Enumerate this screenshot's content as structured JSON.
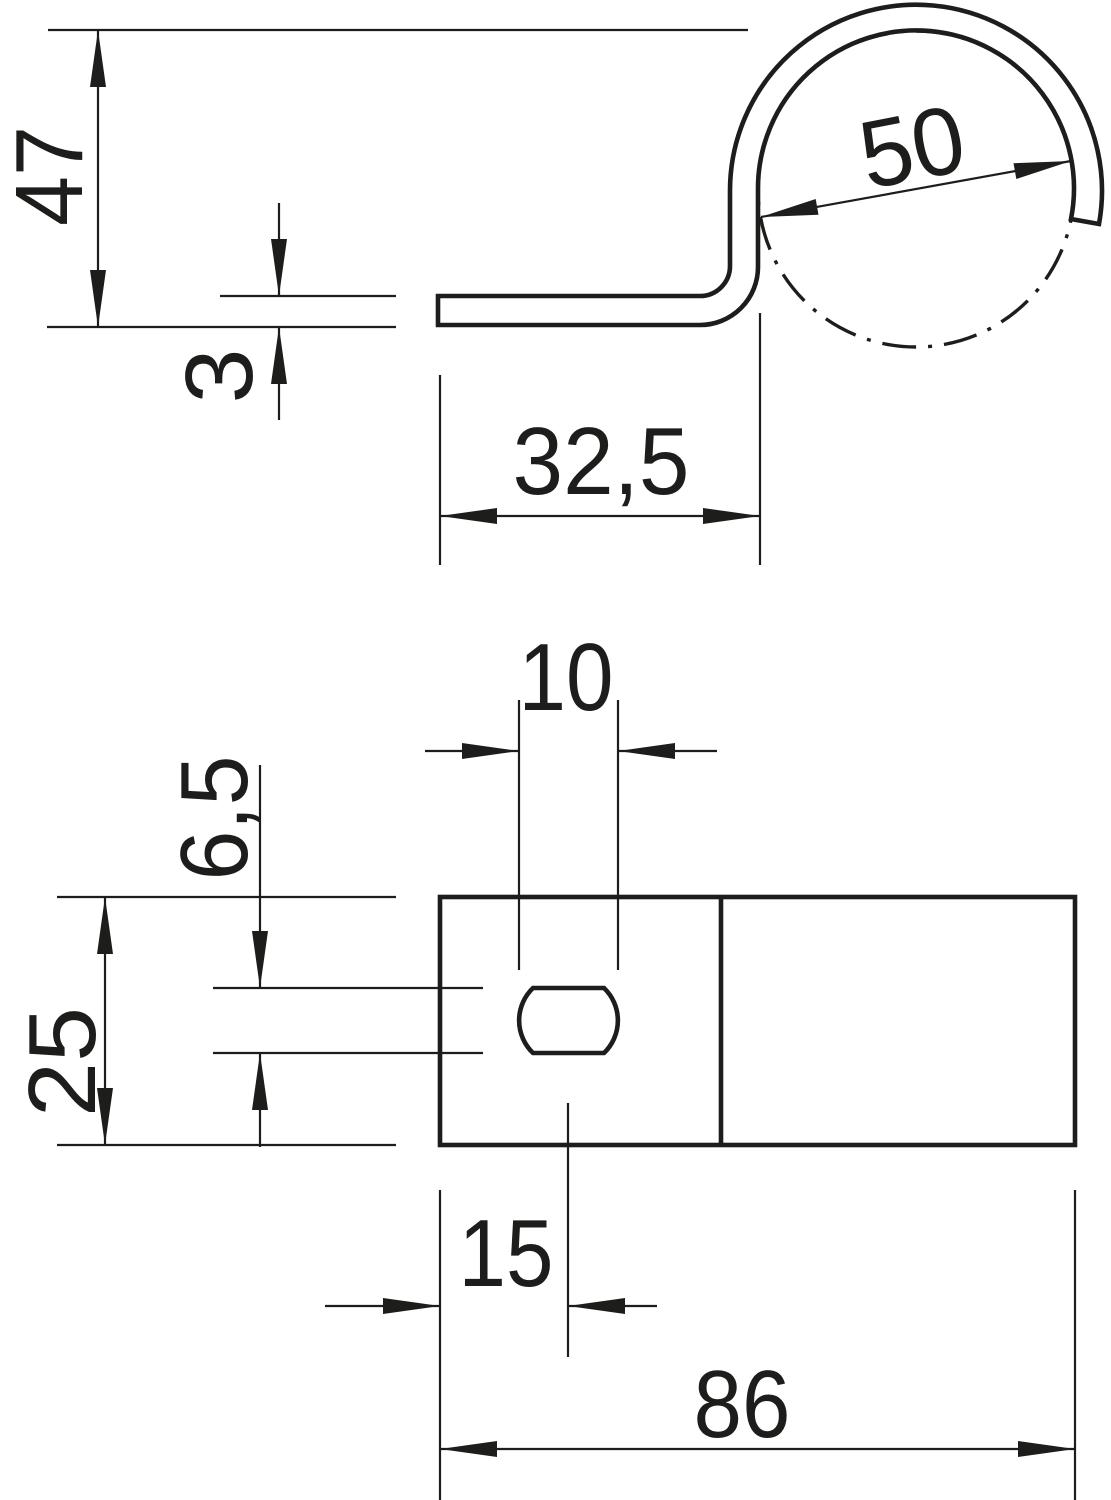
{
  "colors": {
    "line": "#1d1d1b",
    "background": "#ffffff"
  },
  "side_view": {
    "height": "47",
    "material_thickness": "3",
    "clamp_diameter": "50",
    "foot_length": "32,5"
  },
  "top_view": {
    "slot_length": "10",
    "slot_width": "6,5",
    "plate_width": "25",
    "slot_center_from_end": "15",
    "total_length": "86"
  }
}
